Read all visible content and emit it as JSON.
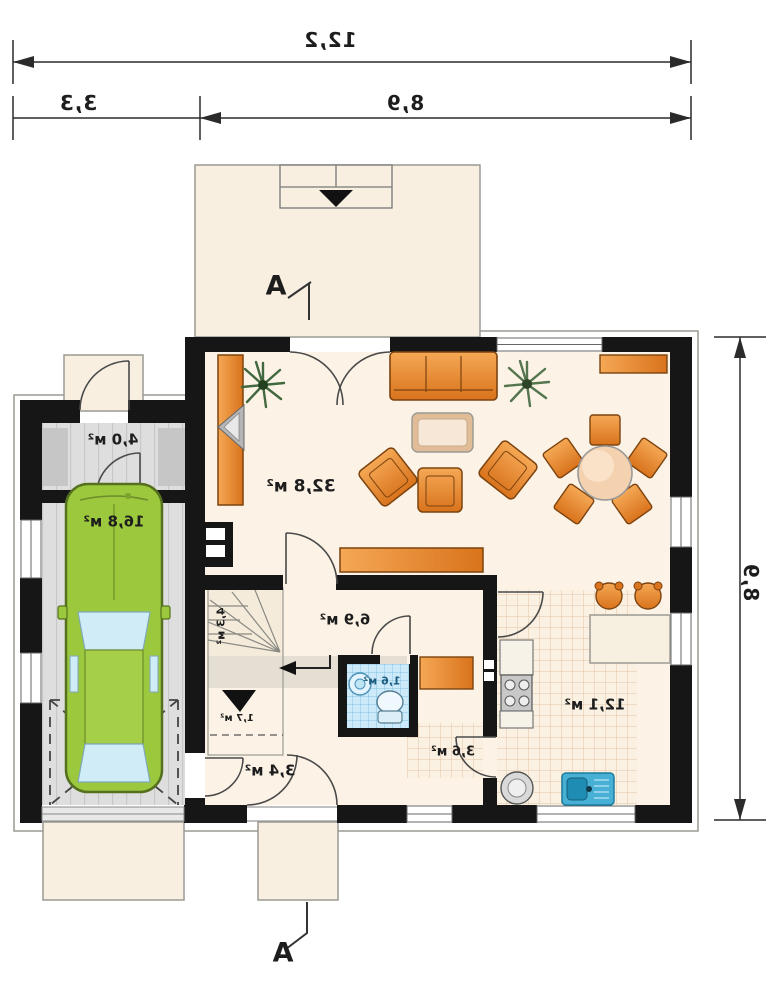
{
  "plan": {
    "title": "single-storey house floor plan (mirrored print)",
    "dimensions": {
      "top_total": "12,2",
      "top_left": "3,3",
      "top_right": "8,9",
      "right_side": "8,9"
    },
    "section_top": "A",
    "section_bottom": "A",
    "rooms": [
      {
        "id": "storage",
        "area": "4,0 м²"
      },
      {
        "id": "garage",
        "area": "16,8 м²"
      },
      {
        "id": "living-room",
        "area": "32,8 м²"
      },
      {
        "id": "hall",
        "area": "6,9 м²"
      },
      {
        "id": "stairs",
        "area": "4,3 м²"
      },
      {
        "id": "under-stairs",
        "area": "1,7 м²"
      },
      {
        "id": "wc",
        "area": "1,6 м²"
      },
      {
        "id": "entry-hall",
        "area": "3,4 м²"
      },
      {
        "id": "corridor",
        "area": "3,6 м²"
      },
      {
        "id": "kitchen",
        "area": "12,1 м²"
      }
    ],
    "colors": {
      "wall": "#161616",
      "floor_cream": "#fbf2e4",
      "floor_gray": "#dedede",
      "tile_blue": "#cdeafa",
      "furniture_orange": "#e8872b",
      "car_green": "#9cc83e",
      "dim_line": "#2b2b2b"
    }
  }
}
